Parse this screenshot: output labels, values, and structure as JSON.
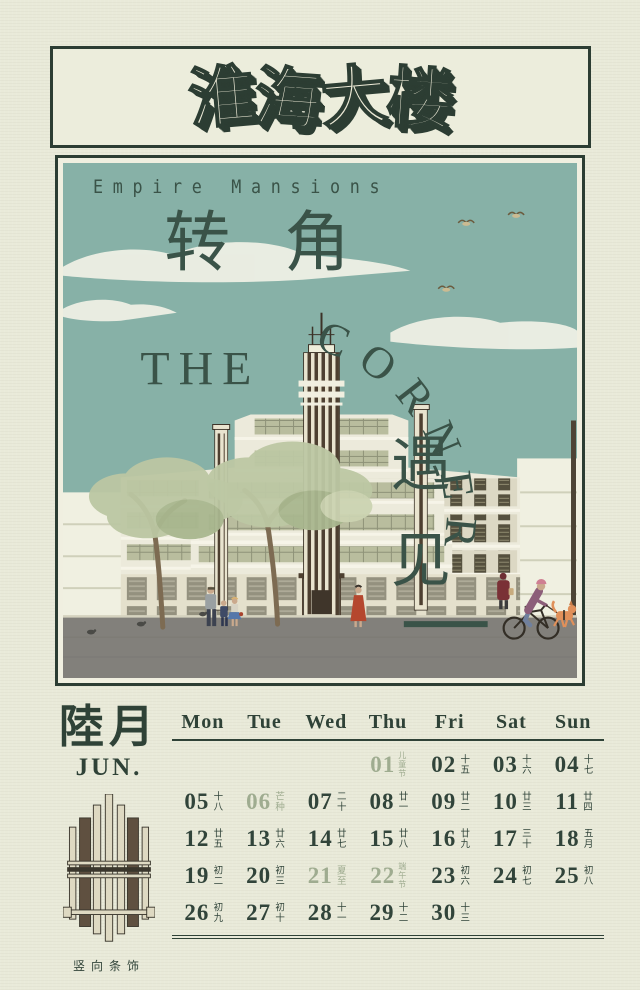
{
  "poster": {
    "title": "淮海大楼",
    "subtitle": "Empire Mansions",
    "logo": {
      "top": "转角",
      "the": "THE",
      "corner": "CORNER",
      "side": "遇见"
    },
    "scene_elements": [
      "teal-sky",
      "clouds",
      "flying-birds",
      "art-deco-building-with-striped-tower",
      "street-trees",
      "pedestrians",
      "cyclist-walking-dog",
      "pigeons",
      "gray-road"
    ]
  },
  "calendar": {
    "month_cn": "陸月",
    "month_en": "JUN.",
    "ornament_caption": "竖向条饰",
    "day_headers": [
      "Mon",
      "Tue",
      "Wed",
      "Thu",
      "Fri",
      "Sat",
      "Sun"
    ],
    "weeks": [
      [
        null,
        null,
        null,
        {
          "day": "01",
          "label": "儿童节",
          "special": true
        },
        {
          "day": "02",
          "label": "十五"
        },
        {
          "day": "03",
          "label": "十六"
        },
        {
          "day": "04",
          "label": "十七"
        }
      ],
      [
        {
          "day": "05",
          "label": "十八"
        },
        {
          "day": "06",
          "label": "芒种",
          "special": true
        },
        {
          "day": "07",
          "label": "二十"
        },
        {
          "day": "08",
          "label": "廿一"
        },
        {
          "day": "09",
          "label": "廿二"
        },
        {
          "day": "10",
          "label": "廿三"
        },
        {
          "day": "11",
          "label": "廿四"
        }
      ],
      [
        {
          "day": "12",
          "label": "廿五"
        },
        {
          "day": "13",
          "label": "廿六"
        },
        {
          "day": "14",
          "label": "廿七"
        },
        {
          "day": "15",
          "label": "廿八"
        },
        {
          "day": "16",
          "label": "廿九"
        },
        {
          "day": "17",
          "label": "三十"
        },
        {
          "day": "18",
          "label": "五月"
        }
      ],
      [
        {
          "day": "19",
          "label": "初二"
        },
        {
          "day": "20",
          "label": "初三"
        },
        {
          "day": "21",
          "label": "夏至",
          "special": true
        },
        {
          "day": "22",
          "label": "端午节",
          "special": true
        },
        {
          "day": "23",
          "label": "初六"
        },
        {
          "day": "24",
          "label": "初七"
        },
        {
          "day": "25",
          "label": "初八"
        }
      ],
      [
        {
          "day": "26",
          "label": "初九"
        },
        {
          "day": "27",
          "label": "初十"
        },
        {
          "day": "28",
          "label": "十一"
        },
        {
          "day": "29",
          "label": "十二"
        },
        {
          "day": "30",
          "label": "十三"
        }
      ]
    ]
  },
  "colors": {
    "paper": "#e9ead9",
    "ink": "#2f4237",
    "sky_teal": "#87b1a7",
    "accent_green": "#9fac90",
    "stripe_brown": "#4d3f30",
    "road_gray": "#82807b",
    "dog_orange": "#e0905a"
  }
}
